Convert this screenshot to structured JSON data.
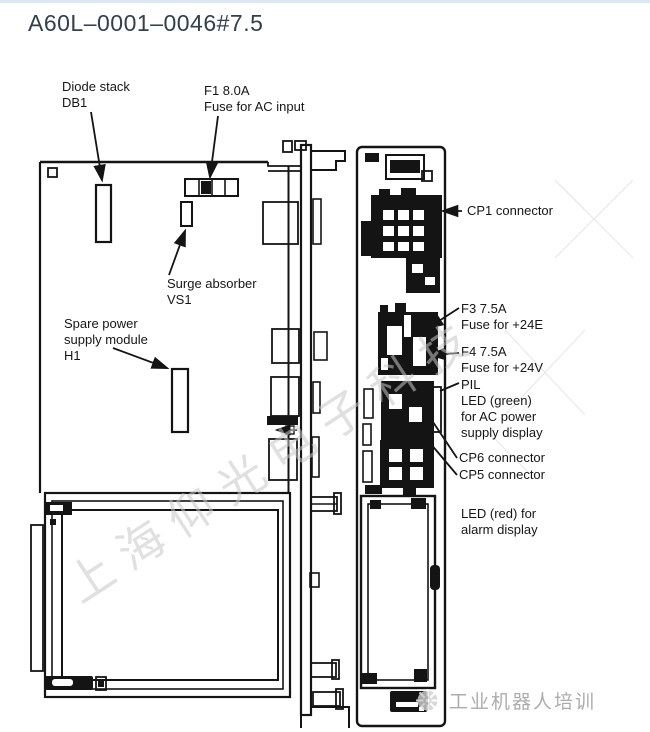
{
  "title": "A60L–0001–0046#7.5",
  "labels": {
    "diode_stack": "Diode stack\nDB1",
    "fuse_f1": "F1 8.0A\nFuse for AC input",
    "surge_absorber": "Surge absorber\nVS1",
    "spare_power_module": "Spare power\nsupply module\nH1",
    "cp1": "CP1 connector",
    "fuse_f3": "F3 7.5A\nFuse for +24E",
    "fuse_f4": "F4 7.5A\nFuse for +24V",
    "pil_led": "PIL\nLED (green)\nfor AC power\nsupply display",
    "cp6": "CP6 connector",
    "cp5": "CP5 connector",
    "led_red": "LED (red) for\nalarm display"
  },
  "watermarks": {
    "center": "上海仰光电子科技",
    "footer": "工业机器人培训"
  },
  "colors": {
    "title": "#32404e",
    "diagram_line": "#141414",
    "watermark": "#c7c7c7"
  }
}
